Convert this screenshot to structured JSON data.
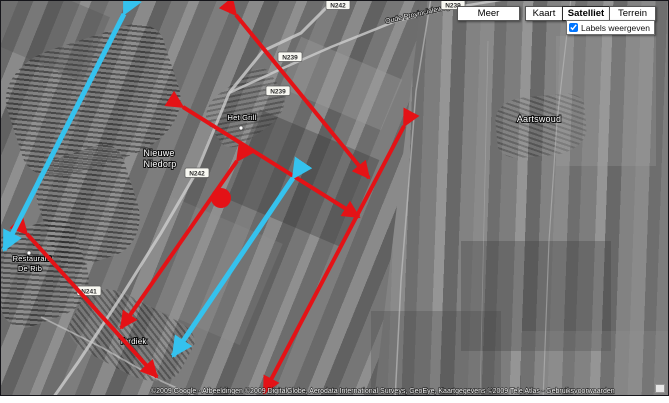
{
  "controls": {
    "map_type_buttons": [
      {
        "label": "Meer",
        "selected": false
      },
      {
        "label": "Kaart",
        "selected": false
      },
      {
        "label": "Satelliet",
        "selected": true
      },
      {
        "label": "Terrein",
        "selected": false
      }
    ],
    "labels_toggle": {
      "label": "Labels weergeven",
      "checked": true
    }
  },
  "map": {
    "place_labels": [
      {
        "text": "Nieuwe",
        "x": 158,
        "y": 155,
        "fs": 9
      },
      {
        "text": "Niedorp",
        "x": 159,
        "y": 166,
        "fs": 9
      },
      {
        "text": "Het Grill",
        "x": 241,
        "y": 119,
        "fs": 7.5
      },
      {
        "text": "Aartswoud",
        "x": 538,
        "y": 121,
        "fs": 9
      },
      {
        "text": "Restaurant",
        "x": 31,
        "y": 260,
        "fs": 7.5
      },
      {
        "text": "De Rib",
        "x": 29,
        "y": 270,
        "fs": 7.5
      },
      {
        "text": "Terdiek",
        "x": 132,
        "y": 343,
        "fs": 8
      }
    ],
    "road_name_labels": [
      {
        "text": "Oude Provincialeweg",
        "x": 417,
        "y": 15,
        "rotate": -13,
        "fs": 7
      }
    ],
    "road_shields": [
      {
        "text": "N242",
        "x": 337,
        "y": 4
      },
      {
        "text": "N239",
        "x": 452,
        "y": 4
      },
      {
        "text": "N239",
        "x": 289,
        "y": 56
      },
      {
        "text": "N239",
        "x": 277,
        "y": 90
      },
      {
        "text": "N242",
        "x": 196,
        "y": 172
      },
      {
        "text": "N241",
        "x": 88,
        "y": 290
      }
    ],
    "poi_dots": [
      {
        "x": 240,
        "y": 127
      },
      {
        "x": 28,
        "y": 252
      }
    ],
    "attribution": "©2009 Google - Afbeeldingen ©2009 DigitalGlobe, Aerodata International Surveys, GeoEye, Kaartgegevens ©2009 Tele Atlas - Gebruiksvoorwaarden"
  },
  "overlay": {
    "colors": {
      "red": "#e41216",
      "cyan": "#35c2ee"
    },
    "dot": {
      "x": 220,
      "y": 197,
      "r": 10
    },
    "arrows": [
      {
        "x1": 235,
        "y1": 14,
        "x2": 368,
        "y2": 177,
        "color": "red"
      },
      {
        "x1": 182,
        "y1": 106,
        "x2": 358,
        "y2": 216,
        "color": "red"
      },
      {
        "x1": 403,
        "y1": 125,
        "x2": 263,
        "y2": 392,
        "color": "red"
      },
      {
        "x1": 26,
        "y1": 233,
        "x2": 156,
        "y2": 376,
        "color": "red"
      },
      {
        "x1": 236,
        "y1": 160,
        "x2": 120,
        "y2": 327,
        "color": "red"
      },
      {
        "x1": 123,
        "y1": 13,
        "x2": 3,
        "y2": 249,
        "color": "cyan"
      },
      {
        "x1": 292,
        "y1": 177,
        "x2": 172,
        "y2": 355,
        "color": "cyan"
      }
    ]
  }
}
